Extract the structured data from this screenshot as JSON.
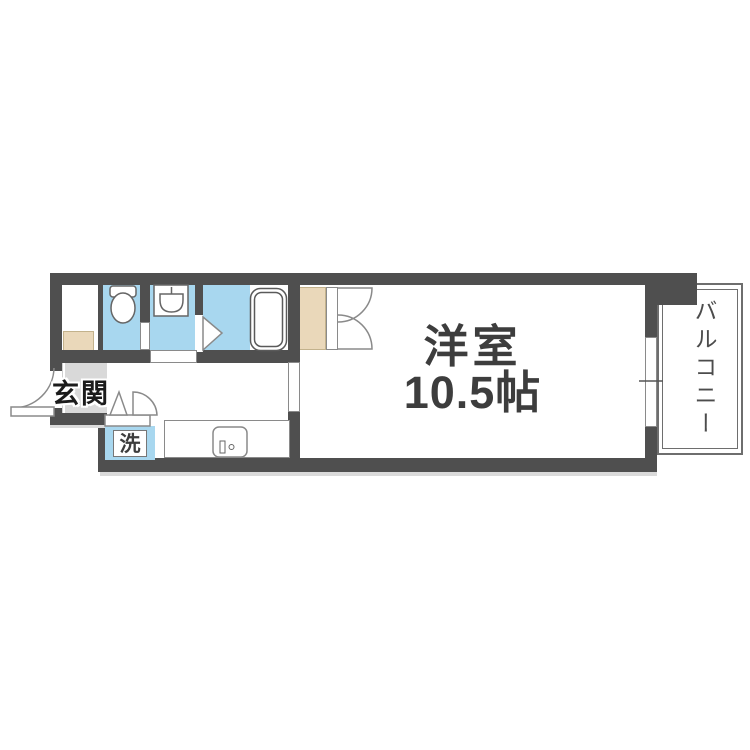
{
  "floorplan": {
    "rooms": {
      "main_room": {
        "name": "洋室",
        "size": "10.5帖"
      },
      "balcony": {
        "name": "バルコニー"
      },
      "entrance": {
        "name": "玄関"
      },
      "laundry": {
        "name": "洗"
      }
    },
    "colors": {
      "wall": "#4f4f4f",
      "water_area_blue": "#a8d7ef",
      "closet_beige": "#ead8ba",
      "entrance_floor_gray": "#d6d6d6",
      "fixture_outline_gray": "#777777",
      "label_text": "#3d3d3d"
    },
    "icons": [
      "toilet-icon",
      "washbasin-icon",
      "bathtub-icon",
      "kitchen-sink-icon",
      "entrance-door-swing-icon",
      "closet-double-door-icon",
      "bathroom-door-icon",
      "bifold-door-icon",
      "window-icon"
    ]
  }
}
